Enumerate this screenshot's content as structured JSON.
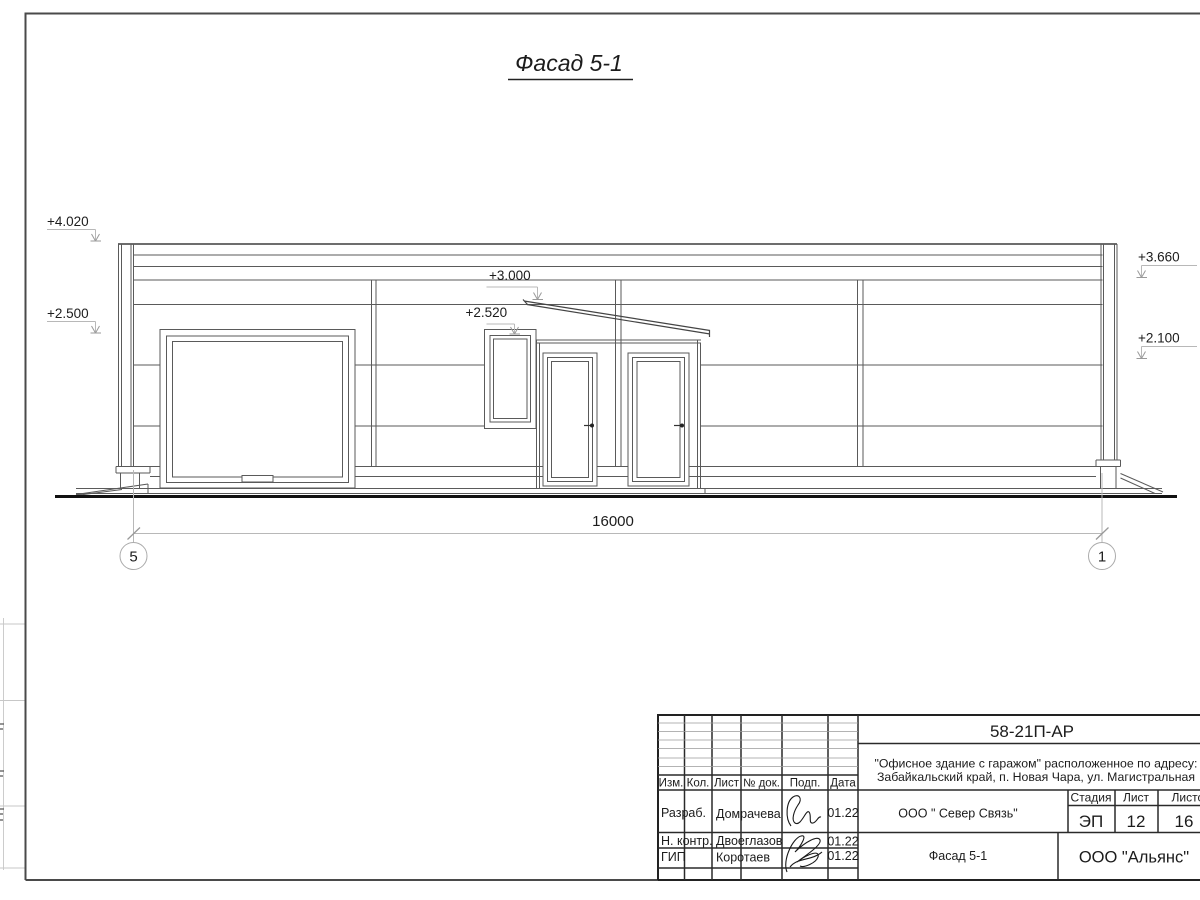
{
  "page": {
    "drawing_title": "Фасад 5-1"
  },
  "facade": {
    "elevations": {
      "left_top": "+4.020",
      "left_garage": "+2.500",
      "canopy": "+3.000",
      "window": "+2.520",
      "right_top": "+3.660",
      "right_wall": "+2.100"
    },
    "dimension_total": "16000",
    "axis_left": "5",
    "axis_right": "1"
  },
  "title_block": {
    "doc_code": "58-21П-АР",
    "project_line1": "\"Офисное здание с гаражом\" расположенное по адресу:",
    "project_line2": "Забайкальский край, п. Новая Чара, ул. Магистральная",
    "header_cols": {
      "izm": "Изм.",
      "kol": "Кол.",
      "list": "Лист",
      "doc": "№ док.",
      "podp": "Подп.",
      "data": "Дата"
    },
    "signature_rows": [
      {
        "role": "Разраб.",
        "name": "Домрачева",
        "date": "01.22"
      },
      {
        "role": "Н. контр.",
        "name": "Двоеглазов",
        "date": "01.22"
      },
      {
        "role": "ГИП",
        "name": "Коротаев",
        "date": "01.22"
      }
    ],
    "customer": "ООО \" Север Связь\"",
    "sheet_name": "Фасад 5-1",
    "stage_label": "Стадия",
    "sheet_label": "Лист",
    "sheets_label": "Листов",
    "stage": "ЭП",
    "sheet_number": "12",
    "sheets_total": "16",
    "company": "ООО \"Альянс\""
  },
  "colors": {
    "line_dark": "#222222",
    "line_mid": "#5a5a5a",
    "line_light": "#b8b8b8",
    "paper": "#ffffff"
  }
}
